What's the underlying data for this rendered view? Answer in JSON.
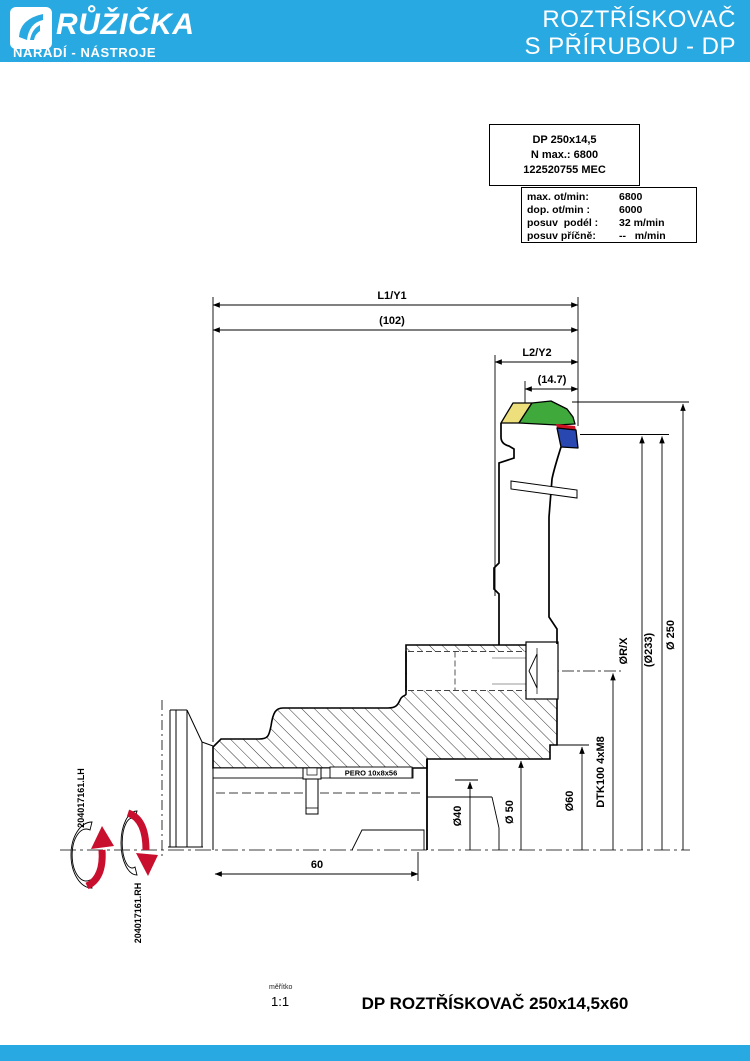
{
  "colors": {
    "accent": "#29a9e1",
    "tip_yellow": "#ecdf7c",
    "tip_green": "#3fa93c",
    "tip_red": "#cc1122",
    "tip_blue": "#2847b0",
    "arrow_red": "#c8102e"
  },
  "header": {
    "brand": "RŮŽIČKA",
    "brand_sub": "NÁŘADÍ - NÁSTROJE",
    "title_line1": "ROZTŘÍSKOVAČ",
    "title_line2": "S PŘÍRUBOU - DP"
  },
  "info_card": {
    "model": "DP 250x14,5",
    "n_max": "N max.: 6800",
    "code": "122520755 MEC"
  },
  "specs": {
    "rows": [
      {
        "label": "max. ot/min:",
        "value": "6800"
      },
      {
        "label": "dop. ot/min :",
        "value": "6000"
      },
      {
        "label": "posuv  podél :",
        "value": "32 m/min"
      },
      {
        "label": "posuv příčně:",
        "value": "--   m/min"
      }
    ]
  },
  "drawing": {
    "dim_l1": "L1/Y1",
    "dim_l1_value": "(102)",
    "dim_l2": "L2/Y2",
    "dim_l2_value": "(14.7)",
    "dia_250": "Ø 250",
    "dia_233": "(Ø233)",
    "dia_rx": "ØR/X",
    "bolt_circle": "DTK100 4xM8",
    "dia_60": "Ø60",
    "dia_50": "Ø 50",
    "dia_40": "Ø40",
    "hub_length": "60",
    "key_label": "PERO 10x8x56",
    "rotation_lh": "204017161.LH",
    "rotation_rh": "204017161.RH"
  },
  "footer": {
    "scale_label": "měřítko",
    "scale_value": "1:1",
    "title": "DP ROZTŘÍSKOVAČ 250x14,5x60"
  }
}
